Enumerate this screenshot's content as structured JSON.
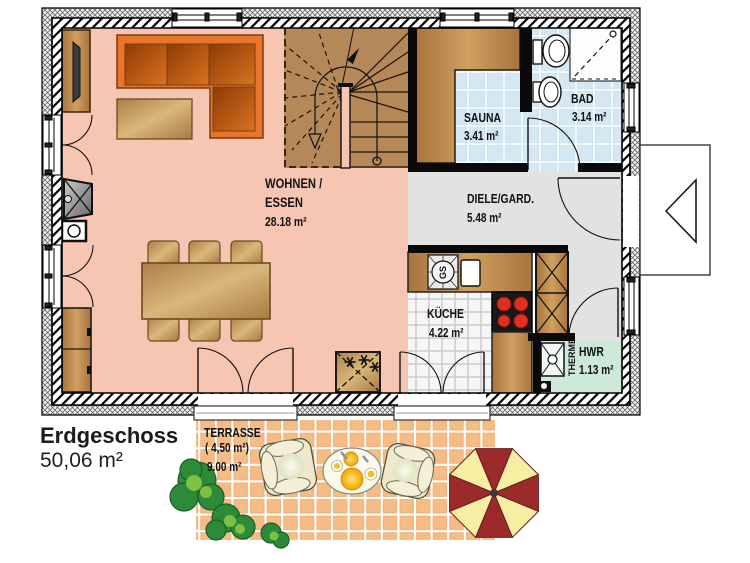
{
  "title": {
    "floor_label": "Erdgeschoss",
    "floor_area": "50,06 m²"
  },
  "rooms": {
    "wohnen_line1": "WOHNEN /",
    "wohnen_line2": "ESSEN",
    "wohnen_area": "28.18 m²",
    "sauna_name": "SAUNA",
    "sauna_area": "3.41 m²",
    "bad_name": "BAD",
    "bad_area": "3.14 m²",
    "diele_name": "DIELE/GARD.",
    "diele_area": "5.48 m²",
    "kueche_name": "KÜCHE",
    "kueche_area": "4.22 m²",
    "hwr_name": "HWR",
    "hwr_area": "1.13 m²",
    "terrasse_name": "TERRASSE",
    "terrasse_area_paren": "( 4,50 m²)",
    "terrasse_area": "9.00 m²"
  },
  "appliances": {
    "dishwasher_label": "GS",
    "water_heater_label": "THERME"
  },
  "colors": {
    "wall": "#000000",
    "living_floor": "#f7c6b2",
    "wet_room_tile": "#cfe4f1",
    "hall_floor": "#e2e2e2",
    "kitchen_tile": "#f6f6f6",
    "utility_floor": "#cde9d8",
    "terrace_tile": "#f3b77c",
    "wood": "#b5885a",
    "sofa_orange": "#e8752b",
    "stove_burner": "#e03020",
    "parasol_red": "#9b2a2a",
    "parasol_yellow": "#f6eea2",
    "shrub_green": "#2d8a3a"
  }
}
